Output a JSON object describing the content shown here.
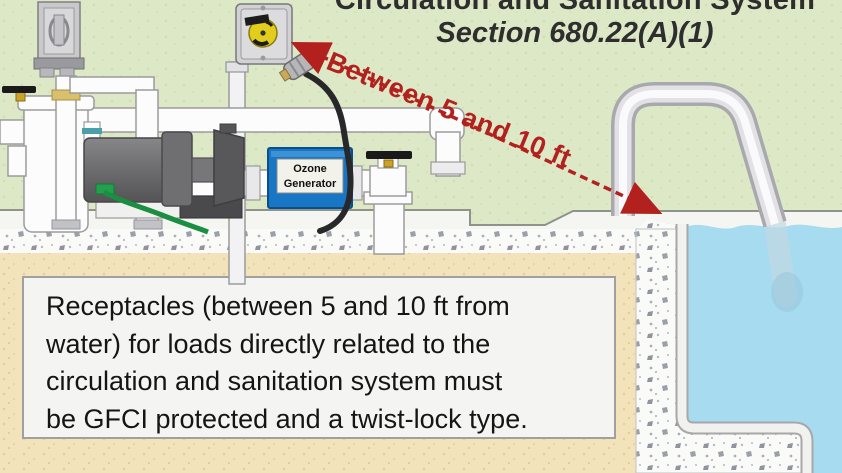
{
  "header": {
    "title": "Circulation and Sanitation System",
    "section": "Section 680.22(A)(1)"
  },
  "annotation": {
    "distance_label": "Between 5 and 10 ft"
  },
  "equipment": {
    "ozone_generator_label": "Ozone\nGenerator"
  },
  "callout": {
    "text": "Receptacles (between 5 and 10 ft from\nwater) for loads directly related to the\ncirculation and sanitation system must\nbe GFCI protected and a twist-lock type."
  },
  "colors": {
    "accent_red": "#b3211f",
    "grass": "#dce8c6",
    "water": "#a7dbef",
    "sand": "#f3e3ba",
    "ozone_blue": "#1876c4",
    "receptacle_yellow": "#e2cd1c",
    "pipe_white": "#fcfcfc",
    "pump_gray": "#6b6b6d"
  }
}
